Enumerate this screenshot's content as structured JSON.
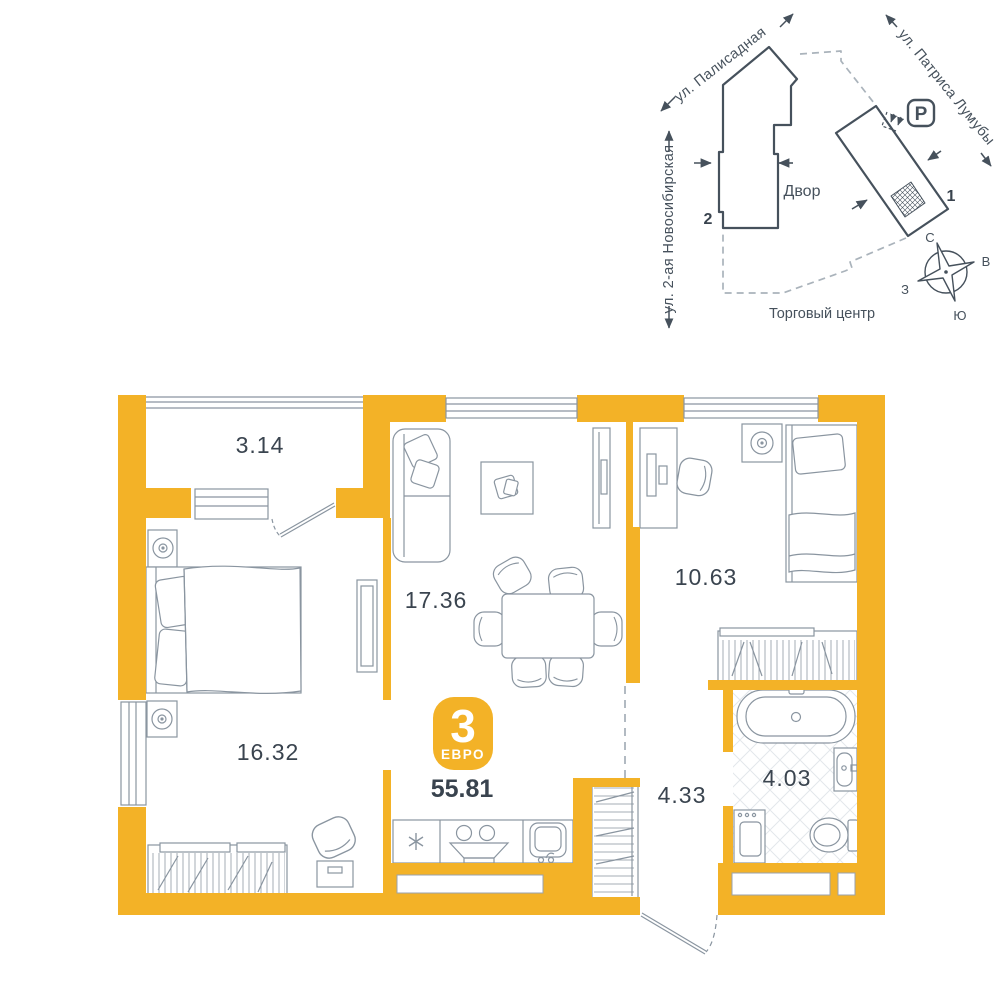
{
  "colors": {
    "wall": "#F3B227",
    "accent_badge": "#F3B227",
    "line_dark": "#46515C",
    "line_light": "#8A95A0",
    "dashed": "#AAB3BB",
    "tile": "#E3E7EB",
    "text_dark": "#39434E",
    "text_label": "#3A444F"
  },
  "site_plan": {
    "street_palisadnaya": "ул. Палисадная",
    "street_patrisa": "ул. Патриса Лумубы",
    "street_novosibirskaya": "ул. 2-ая Новосибирская",
    "courtyard": "Двор",
    "mall": "Торговый центр",
    "parking": "P",
    "building_1": "1",
    "building_2": "2",
    "compass": {
      "n": "С",
      "e": "В",
      "s": "Ю",
      "w": "З"
    }
  },
  "plan": {
    "rooms": {
      "balcony": "3.14",
      "living": "17.36",
      "bedroom_small": "10.63",
      "bedroom_big": "16.32",
      "hall": "4.33",
      "bathroom": "4.03"
    },
    "badge": {
      "rooms": "3",
      "type": "ЕВРО",
      "total_area": "55.81"
    }
  }
}
